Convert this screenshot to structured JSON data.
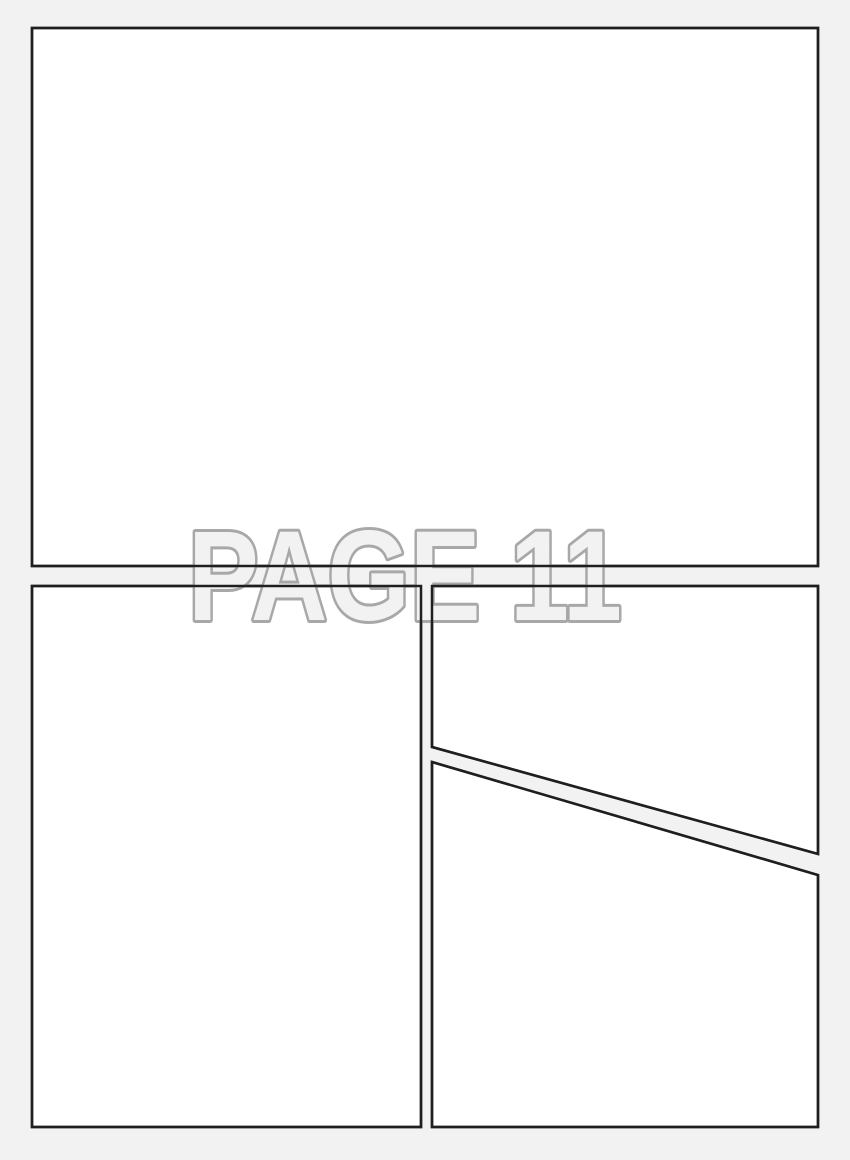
{
  "page_label": {
    "text": "PAGE 11"
  },
  "colors": {
    "page_bg": "#f2f2f2",
    "panel_fill": "#ffffff",
    "panel_border": "#1f1f1f",
    "label_fill": "#f2f2f2",
    "label_stroke": "#a8a8a8"
  },
  "panels": {
    "count": 4,
    "names": [
      "top-panel",
      "bottom-left-panel",
      "top-right-panel",
      "bottom-right-panel"
    ]
  }
}
